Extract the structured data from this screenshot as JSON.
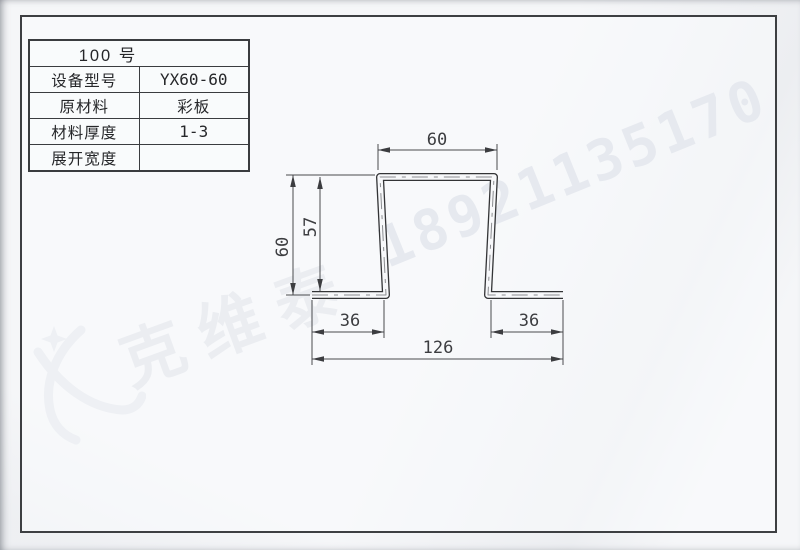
{
  "watermark": {
    "brand_text": "克维泰",
    "phone": "18921135170",
    "brand_color": "#d9dce3",
    "phone_color": "#ced3de"
  },
  "spec_table": {
    "header": "100 号",
    "rows": [
      {
        "label": "设备型号",
        "value": "YX60-60"
      },
      {
        "label": "原材料",
        "value": "彩板"
      },
      {
        "label": "材料厚度",
        "value": "1-3"
      },
      {
        "label": "展开宽度",
        "value": ""
      }
    ]
  },
  "drawing": {
    "dims": {
      "top_width": "60",
      "overall_height": "60",
      "web_height": "57",
      "left_flange": "36",
      "right_flange": "36",
      "overall_width": "126"
    },
    "line_color": "#47484b",
    "profile_color": "#333436"
  }
}
